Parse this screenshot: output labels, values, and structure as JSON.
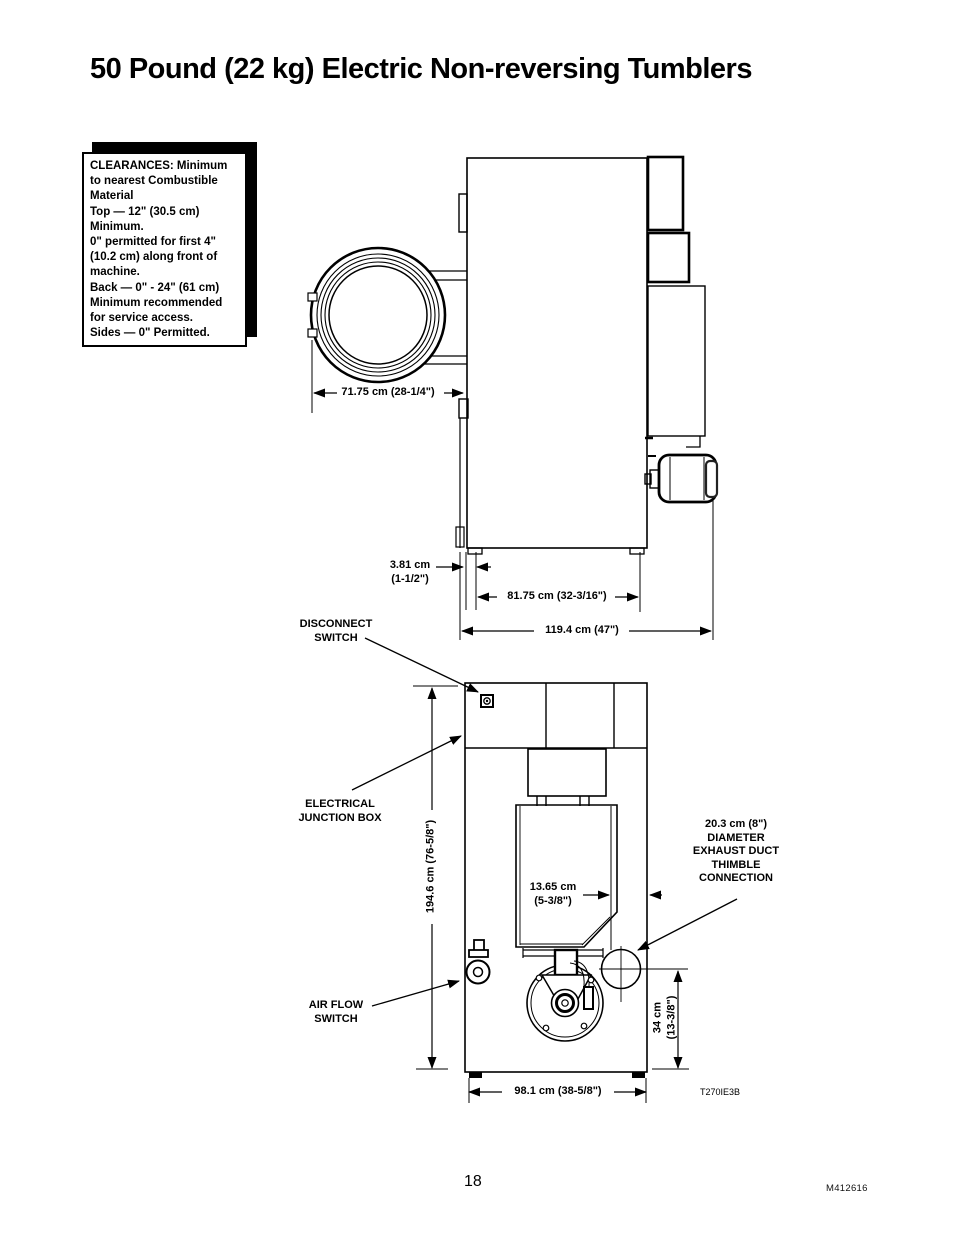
{
  "page": {
    "title": "50 Pound (22 kg) Electric Non-reversing Tumblers",
    "page_number": "18",
    "doc_number": "M412616",
    "figure_code": "T270IE3B"
  },
  "clearances_box": {
    "text": "CLEARANCES: Minimum\n to nearest Combustible\n Material\nTop —  12\" (30.5 cm)\n            Minimum.\n 0\" permitted for first 4\"\n (10.2 cm) along front of\n machine.\nBack  —  0\" - 24\" (61 cm)\n Minimum  recommended\n for service access.\nSides —   0\" Permitted."
  },
  "side_view": {
    "dim_door_depth": "71.75 cm (28-1/4\")",
    "dim_foot_offset": "3.81 cm\n(1-1/2\")",
    "dim_foot_span": "81.75 cm (32-3/16\")",
    "dim_overall_depth": "119.4 cm (47\")"
  },
  "back_view": {
    "label_disconnect_switch": "DISCONNECT\nSWITCH",
    "label_electrical_junction_box": "ELECTRICAL\nJUNCTION BOX",
    "label_air_flow_switch": "AIR FLOW\nSWITCH",
    "label_exhaust": "20.3 cm (8\")\nDIAMETER\nEXHAUST DUCT\nTHIMBLE\nCONNECTION",
    "dim_height": "194.6 cm (76-5/8\")",
    "dim_duct_offset": "13.65 cm\n(5-3/8\")",
    "dim_exhaust_height": "34 cm\n(13-3/8\")",
    "dim_width": "98.1 cm (38-5/8\")"
  }
}
